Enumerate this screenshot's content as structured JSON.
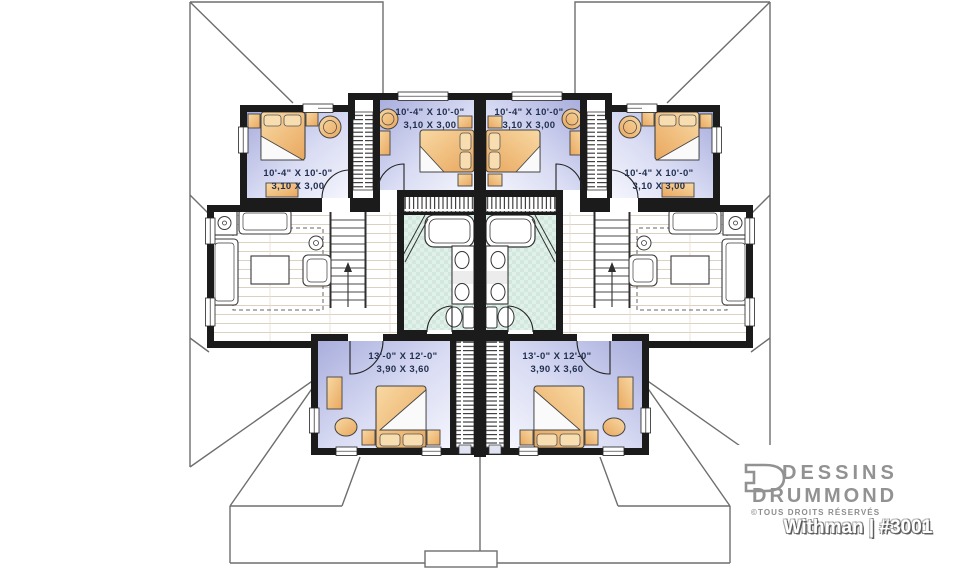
{
  "plan": {
    "room_labels": [
      {
        "name": "bedroom-upper-left",
        "imperial": "10'-4\" X 10'-0\"",
        "metric": "3,10 X 3,00"
      },
      {
        "name": "bedroom-upper-center-left",
        "imperial": "10'-4\" X 10'-0\"",
        "metric": "3,10 X 3,00"
      },
      {
        "name": "bedroom-upper-center-right",
        "imperial": "10'-4\" X 10'-0\"",
        "metric": "3,10 X 3,00"
      },
      {
        "name": "bedroom-upper-right",
        "imperial": "10'-4\" X 10'-0\"",
        "metric": "3,10 X 3,00"
      },
      {
        "name": "bedroom-lower-left",
        "imperial": "13'-0\" X 12'-0\"",
        "metric": "3,90 X 3,60"
      },
      {
        "name": "bedroom-lower-right",
        "imperial": "13'-0\" X 12'-0\"",
        "metric": "3,90 X 3,60"
      }
    ],
    "colors": {
      "wall": "#1b1b1b",
      "bedroom_floor": "#b2b7e2",
      "bathroom_tile": "#d9ece5",
      "furniture_wood": "#f1c183",
      "roof_line": "#6e6e6e",
      "label_text": "#22304f"
    }
  },
  "branding": {
    "name_line1": "DESSINS",
    "name_line2": "DRUMMOND",
    "rights": "©TOUS DROITS RÉSERVÉS",
    "model": "Withman | #3001",
    "logo_color": "#929292"
  }
}
